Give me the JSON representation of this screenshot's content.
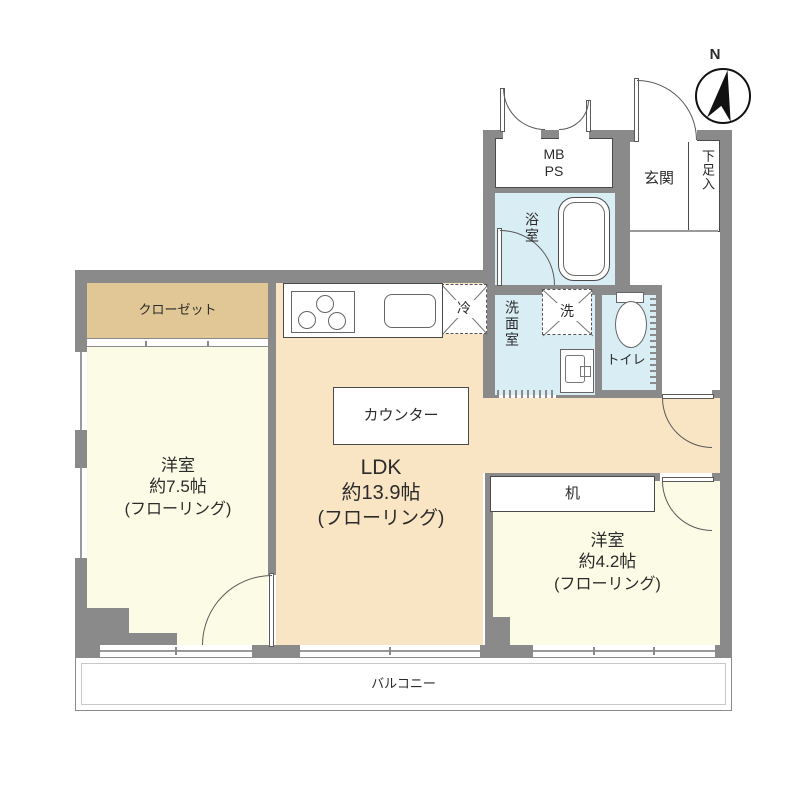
{
  "title": "マンション間取り図",
  "compass": {
    "north_label": "N"
  },
  "labels": {
    "mb": "MB",
    "ps": "PS",
    "entrance": "玄関",
    "shoe_box": "下足入",
    "bathroom": "浴室",
    "washroom": "洗面室",
    "washer": "洗",
    "toilet": "トイレ",
    "fridge": "冷",
    "closet": "クローゼット",
    "kitchen_counter": "カウンター",
    "desk": "机",
    "balcony": "バルコニー"
  },
  "rooms": {
    "western_left": {
      "name": "洋室",
      "size": "約7.5帖",
      "floor": "(フローリング)"
    },
    "ldk": {
      "name": "LDK",
      "size": "約13.9帖",
      "floor": "(フローリング)"
    },
    "western_right": {
      "name": "洋室",
      "size": "約4.2帖",
      "floor": "(フローリング)"
    }
  },
  "colors": {
    "wall": "#8a8a8a",
    "ldk_floor": "#f9e4c4",
    "western_room_floor": "#fbfbe6",
    "closet": "#e0c795",
    "wet_area": "#d9edf5",
    "background": "#ffffff"
  }
}
